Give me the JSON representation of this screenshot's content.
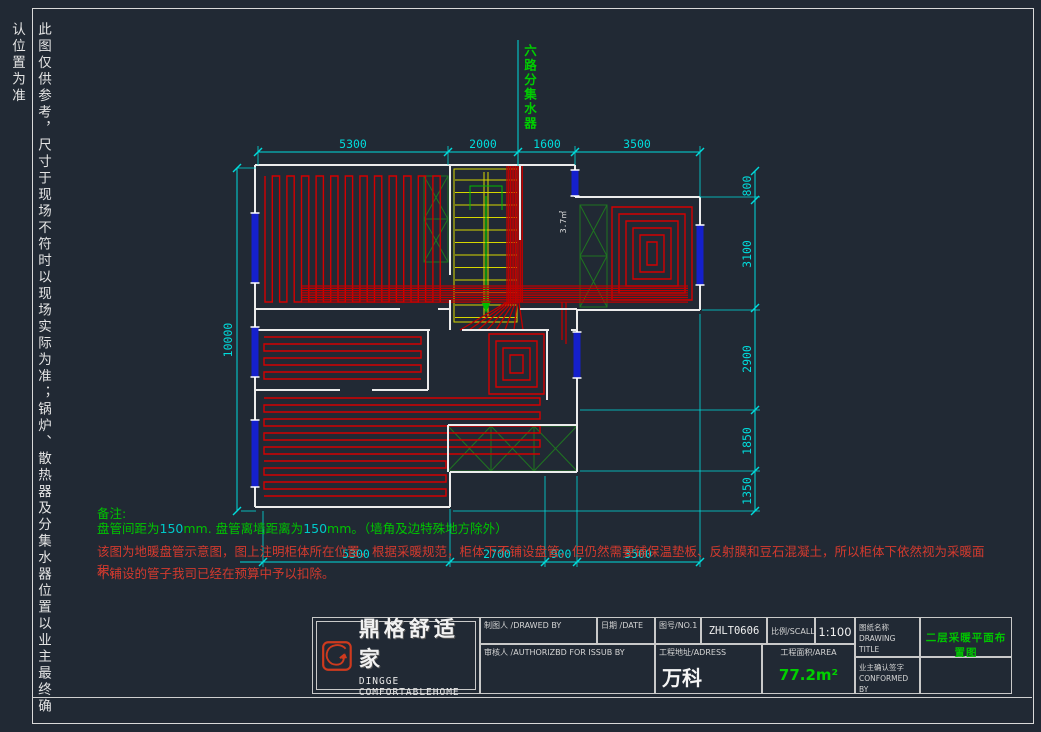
{
  "disclaimer": "此图仅供参考，尺寸于现场不符时以现场实际为准；锅炉、散热器及分集水器位置以业主最终确认位置为准",
  "manifold_label": "六路分集水器",
  "dimensions": {
    "top": [
      "5300",
      "2000",
      "1600",
      "3500"
    ],
    "bottom": [
      "5300",
      "2700",
      "900",
      "3500"
    ],
    "left": [
      "10000"
    ],
    "right": [
      "800",
      "3100",
      "2900",
      "1850",
      "1350"
    ]
  },
  "room_labels": {
    "hall_area": "3.7㎡"
  },
  "notes": {
    "heading": "备注:",
    "line1_a": "盘管间距为",
    "line1_n1": "150",
    "line1_b": "mm. 盘管离墙距离为",
    "line1_n2": "150",
    "line1_c": "mm。（墙角及边特殊地方除外）",
    "line2": "该图为地暖盘管示意图，图上注明柜体所在位置，根据采暖规范，柜体下不铺设盘管，但仍然需要铺保温垫板、反射膜和豆石混凝土，所以柜体下依然视为采暖面积。",
    "line3": "不铺设的管子我司已经在预算中予以扣除。"
  },
  "title_block": {
    "brand_cn": "鼎格舒适家",
    "brand_en": "DINGGE COMFORTABLEHOME",
    "drawn_by_label": "制图人 /DRAWED BY",
    "date_label": "日期 /DATE",
    "checked_label": "审核人 /AUTHORIZBD FOR ISSUB BY",
    "no_label": "图号/NO.1",
    "no_value": "ZHLT0606",
    "scale_label": "比例/SCALL",
    "scale_value": "1:100",
    "address_label": "工程地址/ADRESS",
    "address_value": "万科",
    "area_label": "工程面积/AREA",
    "area_value": "77.2m²",
    "title_label_cn": "图纸名称",
    "title_label_en": "DRAWING TITLE",
    "title_value": "二层采暖平面布置图",
    "confirm_label_cn": "业主确认签字",
    "confirm_label_en": "CONFORMED BY"
  },
  "colors": {
    "background": "#212934",
    "dimension_cyan": "#00dcdc",
    "note_green": "#00c400",
    "note_red": "#d33a2e",
    "coil_red": "#d40000",
    "window_blue": "#1520cc",
    "stair_yellow": "#d6d600",
    "hatch_green": "#1f7d1f",
    "area_green": "#00d000"
  }
}
